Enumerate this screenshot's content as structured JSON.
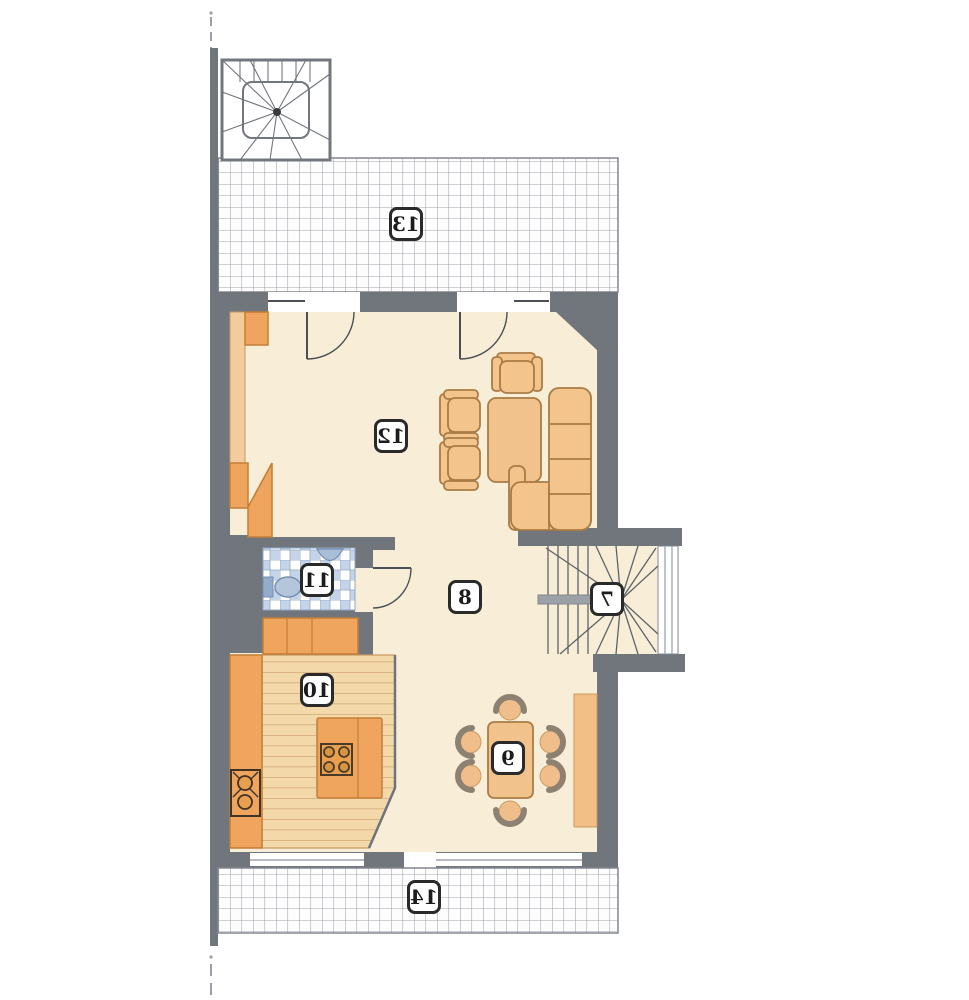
{
  "plan": {
    "type": "floor-plan-mirrored",
    "labels": {
      "staircase": "7",
      "hall": "8",
      "dining": "9",
      "kitchen": "10",
      "bathroom": "11",
      "living": "12",
      "terrace_top": "13",
      "terrace_bottom": "14"
    },
    "colors": {
      "wall": "#71757C",
      "floor": "#F8EED7",
      "furniture": "#F4C48D",
      "furniture_outline": "#A97C45",
      "cabinet": "#F0A55F",
      "cabinet_outline": "#C27E35",
      "plank_floor": "#F3D8A9",
      "plank_line": "#CDA672",
      "tile_blue": "#C5D4E8",
      "fixture_blue": "#A8BDD6",
      "hatch_line": "#9FA4AB",
      "label_border": "#2a2a2a"
    }
  }
}
